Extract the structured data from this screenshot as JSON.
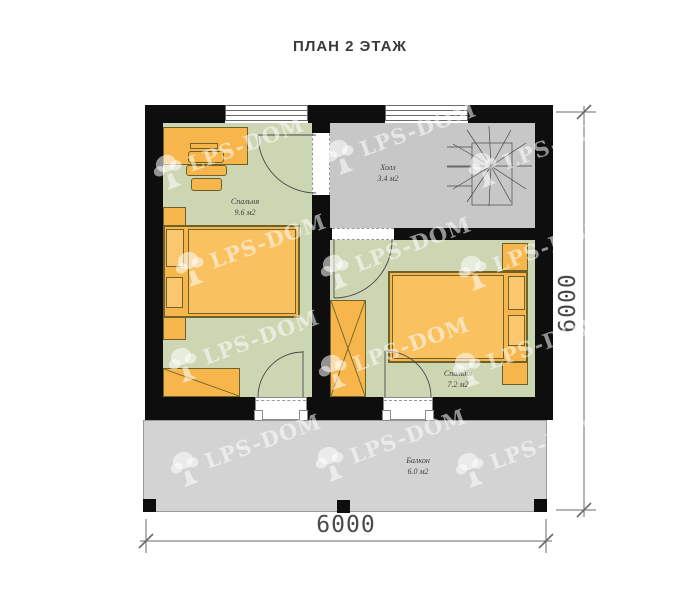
{
  "title": "ПЛАН 2 ЭТАЖ",
  "rooms": [
    {
      "name": "Спальня",
      "area": "9.6 м2"
    },
    {
      "name": "Холл",
      "area": "3.4 м2"
    },
    {
      "name": "Спальня",
      "area": "7.2 м2"
    },
    {
      "name": "Балкон",
      "area": "6.0 м2"
    }
  ],
  "dimensions": {
    "width": "6000",
    "height": "6000"
  },
  "watermark": {
    "text": "LPS-DOM"
  },
  "colors": {
    "wall": "#0e0e0e",
    "floor_bedroom": "#ccd6b2",
    "floor_hall": "#c7c7c7",
    "floor_balcony": "#d3d3d3",
    "furniture": "#f7b64c",
    "furniture_outline": "#6e6228"
  }
}
